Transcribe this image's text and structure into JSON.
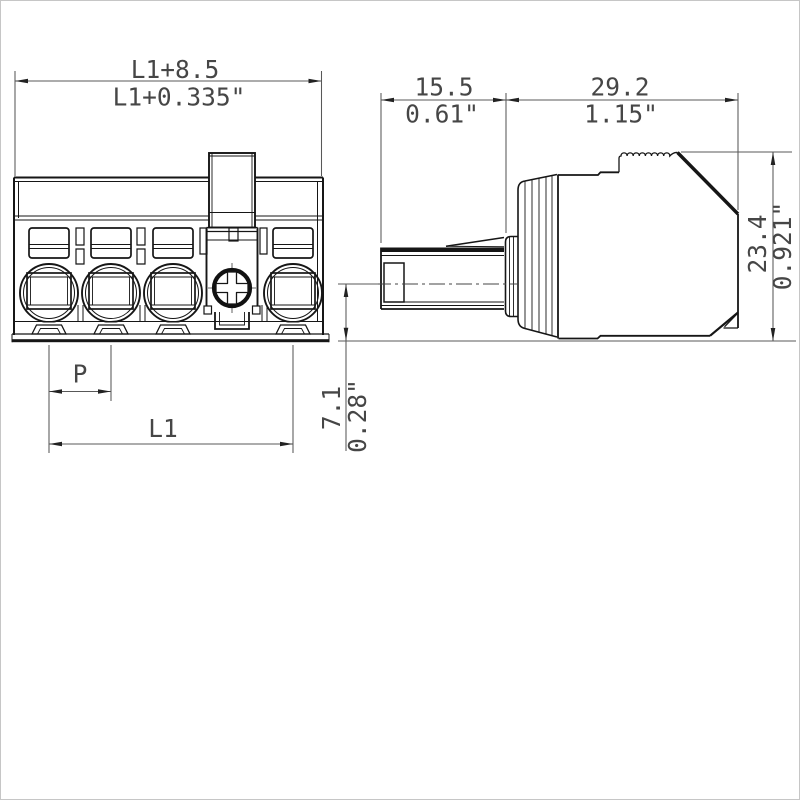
{
  "figure": {
    "type": "technical-dimension-drawing",
    "subject": "pluggable terminal block connector, front view and side view",
    "background_color": "#ffffff",
    "line_color": "#161616",
    "dimension_color": "#464646"
  },
  "front_view": {
    "width_mm": "L1+8.5",
    "width_inch": "L1+0.335\"",
    "pitch_label": "P",
    "length_label": "L1",
    "pole_count": 4
  },
  "side_view": {
    "depth_front_mm": "15.5",
    "depth_front_inch": "0.61\"",
    "depth_body_mm": "29.2",
    "depth_body_inch": "1.15\"",
    "height_mm": "23.4",
    "height_inch": "0.921\"",
    "axis_offset_mm": "7.1",
    "axis_offset_inch": "0.28\""
  }
}
